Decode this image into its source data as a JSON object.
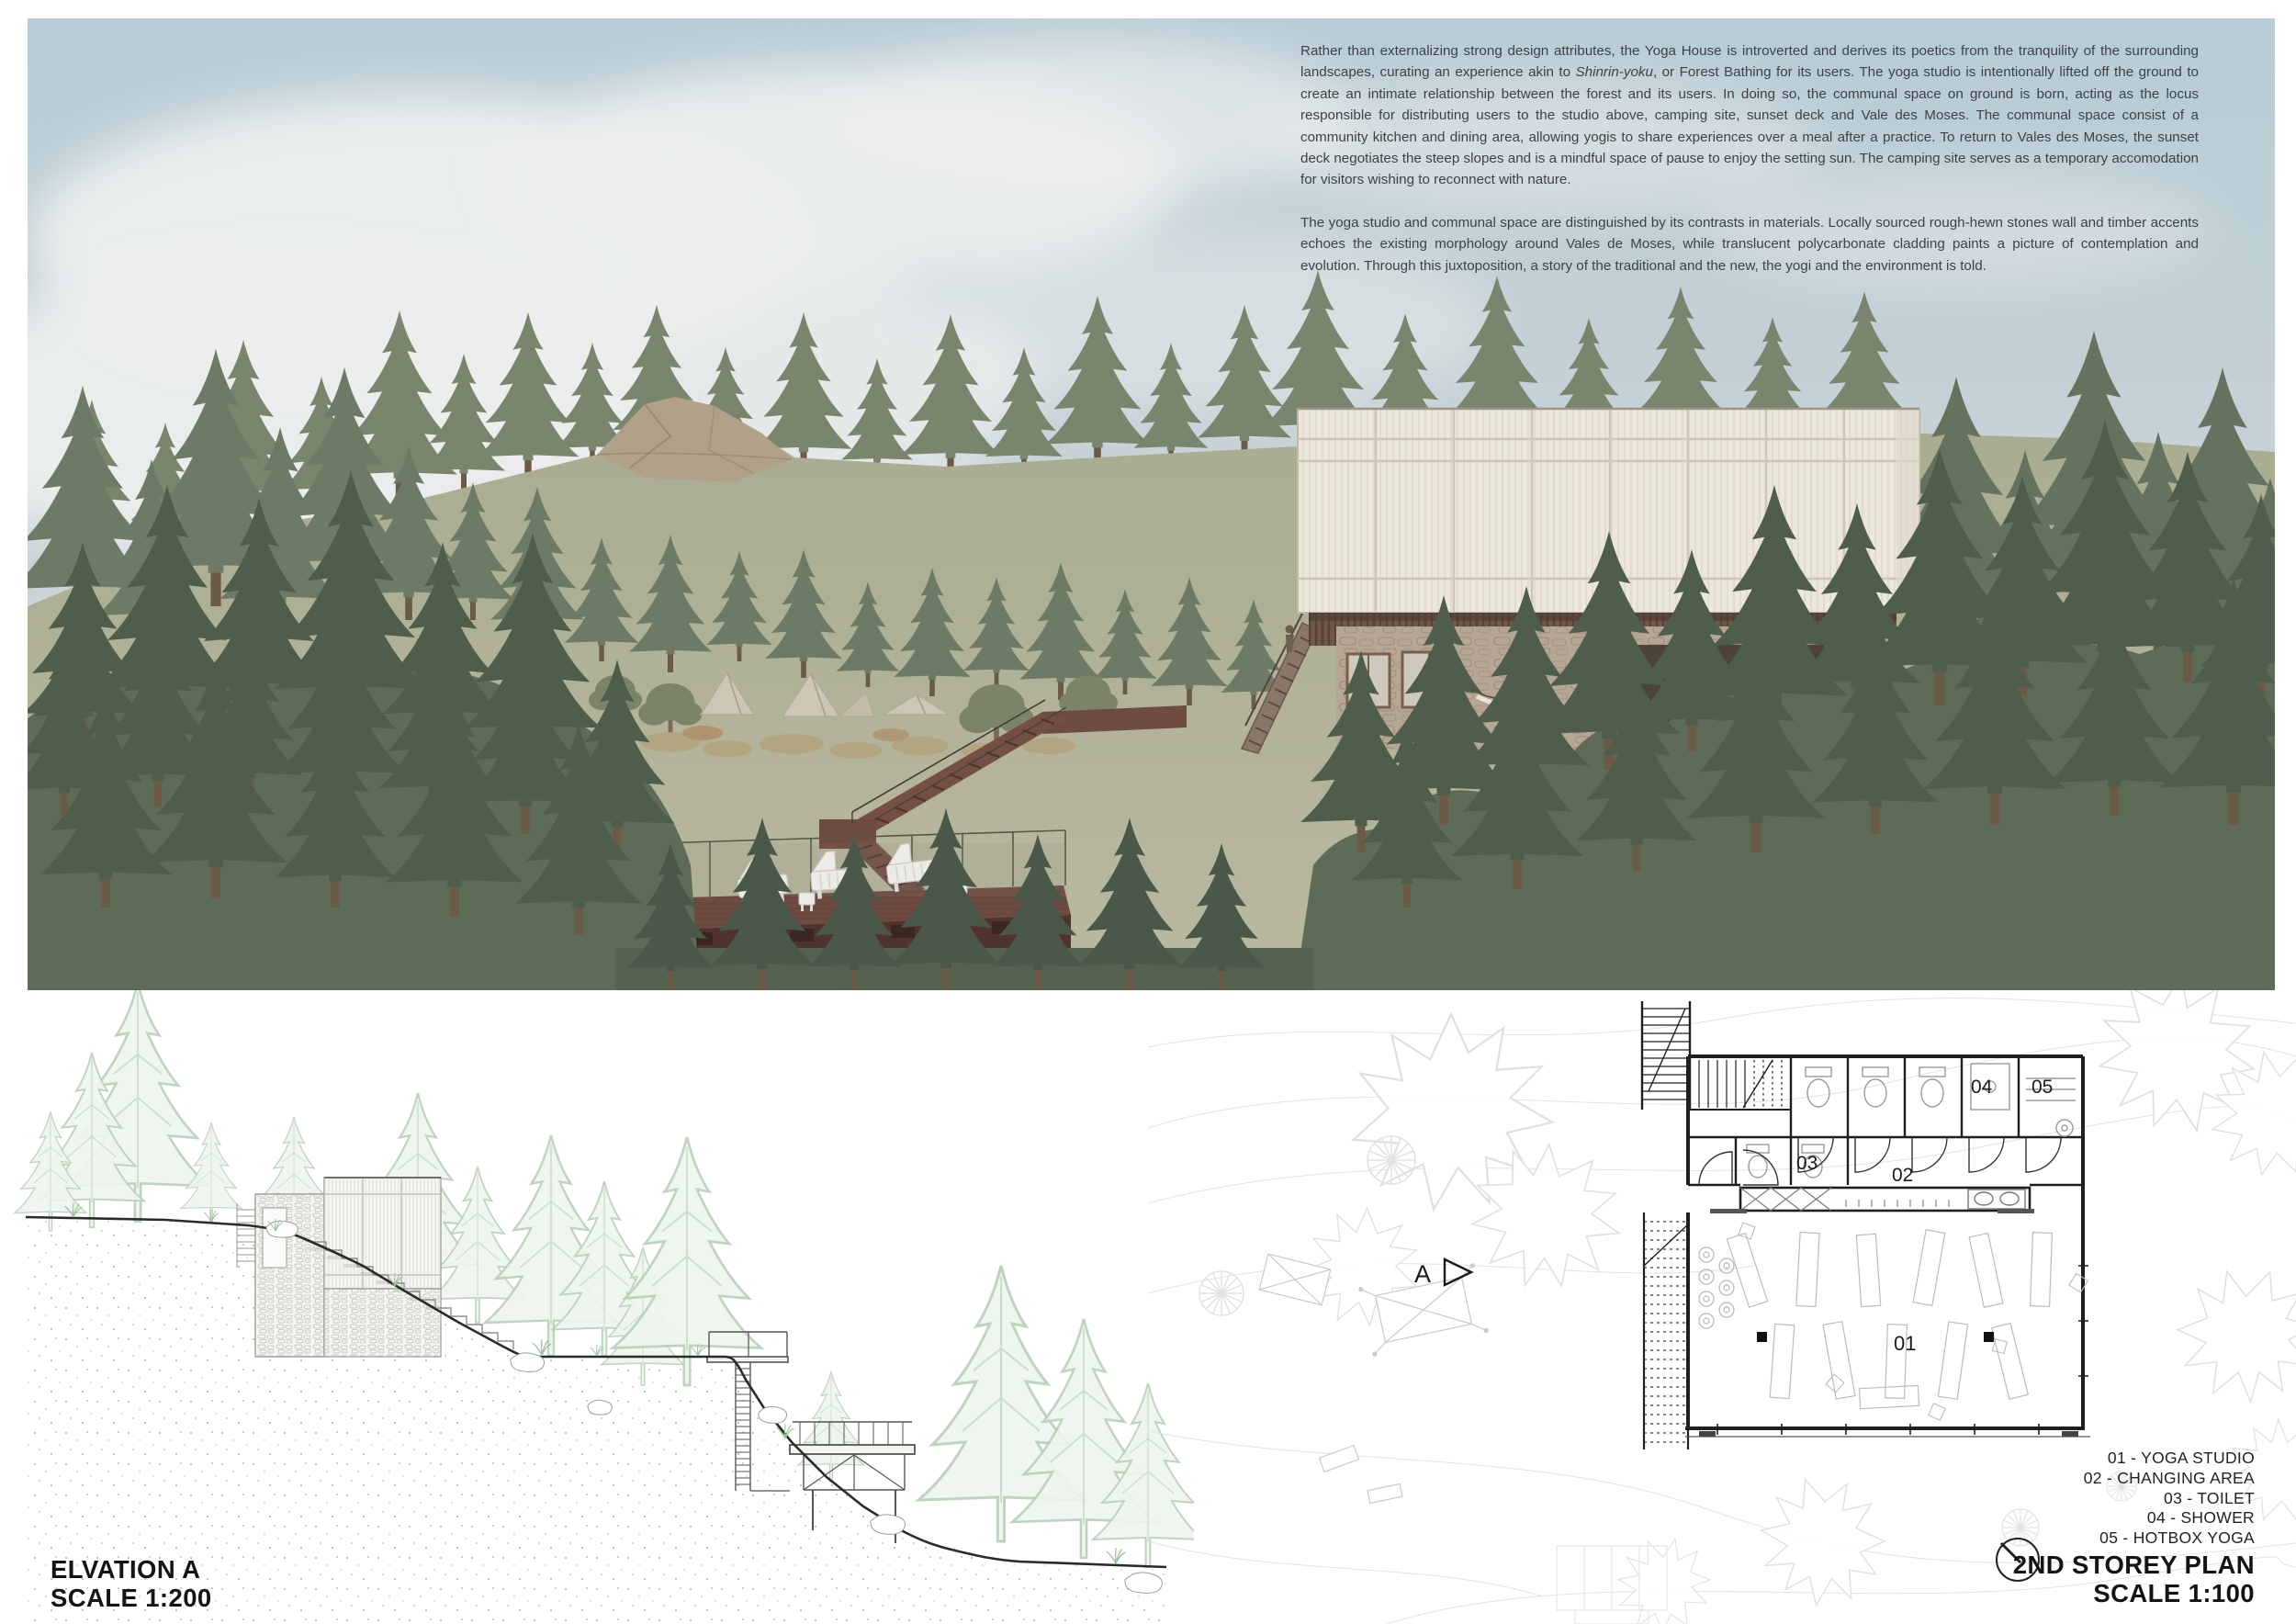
{
  "board": {
    "kind": "architecture presentation board",
    "project": "Yoga House"
  },
  "description": {
    "p1_before": "Rather than externalizing strong design attributes, the Yoga House is introverted and derives its poetics from the tranquility of the surrounding landscapes, curating an experience akin to ",
    "p1_italic": "Shinrin-yoku",
    "p1_after": ", or Forest Bathing for its users. The yoga studio is intentionally lifted off the ground to create an intimate relationship between the forest and its users. In doing so, the communal space on ground is born, acting as the locus responsible for distributing users to the studio above, camping site, sunset deck and Vale des Moses. The communal space consist of a community kitchen and dining area, allowing yogis to share experiences over a meal after a practice. To return to Vales des Moses, the sunset deck negotiates the steep slopes and is a mindful space of pause to enjoy the setting sun. The camping site serves as a temporary accomodation for visitors wishing to reconnect with nature.",
    "p2": "The yoga studio and communal space are distinguished by its contrasts in materials. Locally sourced rough-hewn stones wall and timber accents echoes the existing morphology around Vales de Moses, while translucent polycarbonate cladding paints a picture of contemplation and evolution. Through this juxtoposition, a story of the traditional and the new, the yogi and the environment is told."
  },
  "elevation": {
    "title": "ELVATION A",
    "scale": "SCALE 1:200"
  },
  "plan": {
    "title": "2ND STOREY PLAN",
    "scale": "SCALE 1:100",
    "section_marker": "A",
    "room_labels": [
      "01",
      "02",
      "03",
      "04",
      "05"
    ]
  },
  "legend": {
    "items": [
      "01 - YOGA STUDIO",
      "02 - CHANGING AREA",
      "03 - TOILET",
      "04 - SHOWER",
      "05 - HOTBOX YOGA"
    ]
  },
  "theme": {
    "sky_top": "#b7ccd6",
    "sky_mid": "#c9d3d6",
    "cloud": "#eceeee",
    "hill_top": "#a9ac91",
    "hill_bottom": "#b9b9a0",
    "tree_far": "#7a856e",
    "tree_mid": "#6d7a66",
    "tree_dark": "#5d6b57",
    "tree_deep": "#4f5d4b",
    "polycarbonate": "#ece7db",
    "stone": "#b5a695",
    "timber_band": "#6f5749",
    "deck_wood": "#6f4c41",
    "deck_dark": "#4e342d",
    "tent_canvas": "#cdc6b6",
    "drawing_line": "#2b2b2b",
    "elevation_tree": "#b9d0b9",
    "plan_line": "#1f1f1f",
    "text_color": "#3f4245",
    "title_color": "#141414",
    "label_color": "#222222"
  }
}
